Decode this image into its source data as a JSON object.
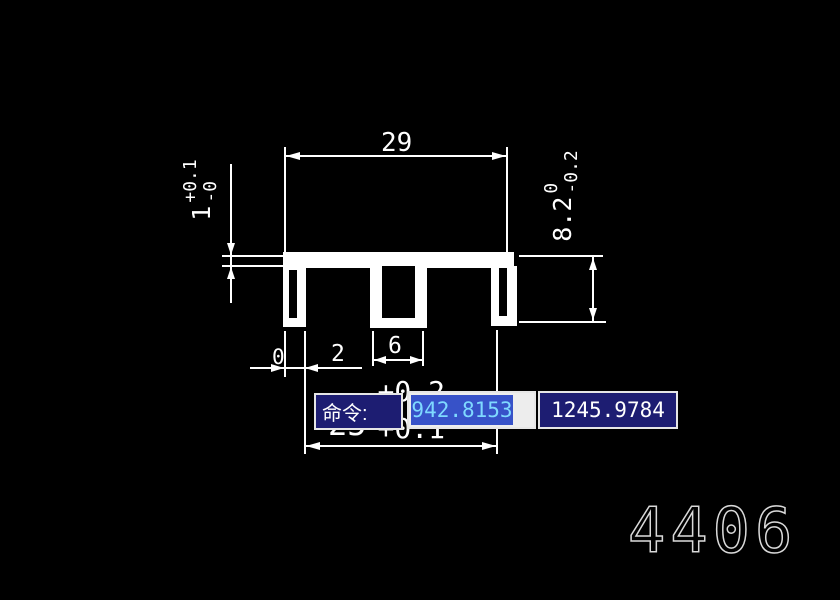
{
  "window": {
    "background": "#000000",
    "line_color": "#ffffff"
  },
  "drawing": {
    "dim_top_width": {
      "value": "29"
    },
    "dim_plate_thickness": {
      "value": "1",
      "tol_upper": "+0.1",
      "tol_lower": "-0"
    },
    "dim_height": {
      "value": "8.2",
      "tol_upper": "0",
      "tol_lower": "-0.2"
    },
    "dim_zero": {
      "value": "0"
    },
    "dim_leg": {
      "value": "2"
    },
    "dim_slot": {
      "value": "6"
    },
    "dim_bottom_width": {
      "value": "25",
      "tol_upper": "+0.2",
      "tol_lower": "+0.1"
    },
    "part_number": "4406"
  },
  "command_bar": {
    "prompt_label": "命令:",
    "coord_x_value": "942.8153",
    "coord_y_value": "1245.9784",
    "colors": {
      "prompt_bg": "#1d1d72",
      "border": "#e6e6e6",
      "selection_bg": "#3752c8",
      "selection_text": "#7fd9ff",
      "field_bg": "#ededed",
      "value_text": "#ffffff"
    }
  }
}
